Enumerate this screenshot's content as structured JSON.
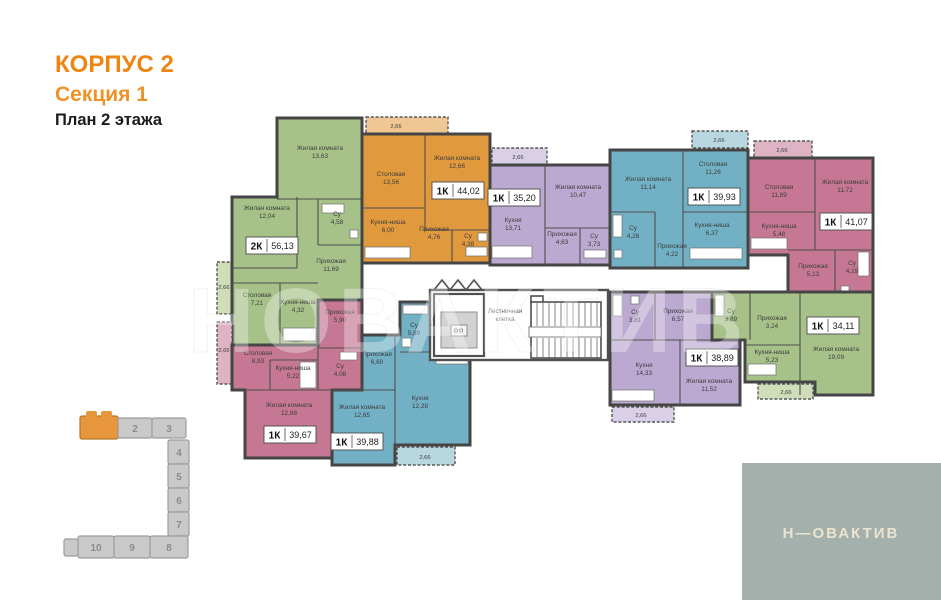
{
  "header": {
    "building": "КОРПУС 2",
    "section": "Секция 1",
    "floor": "План 2 этажа"
  },
  "watermark": "НОВАКТИВ",
  "staircase": {
    "line1": "Лестничная",
    "line2": "клетка"
  },
  "apartments": [
    {
      "id": "apt-2k-5613",
      "type": "2К",
      "total_area": "56,13",
      "color": "#a6c289",
      "balcony_area": "2,66",
      "rooms": [
        {
          "name": "Жилая комната",
          "area": "13,63"
        },
        {
          "name": "Жилая комната",
          "area": "12,04"
        },
        {
          "name": "Су",
          "area": "4,58"
        },
        {
          "name": "Прихожая",
          "area": "11,69"
        },
        {
          "name": "Столовая",
          "area": "7,21"
        },
        {
          "name": "Кухня-ниша",
          "area": "4,32"
        }
      ]
    },
    {
      "id": "apt-1k-4402",
      "type": "1К",
      "total_area": "44,02",
      "color": "#e1993d",
      "balcony_area": "2,66",
      "rooms": [
        {
          "name": "Столовая",
          "area": "13,56"
        },
        {
          "name": "Жилая комната",
          "area": "12,66"
        },
        {
          "name": "Кухня-ниша",
          "area": "6,00"
        },
        {
          "name": "Прихожая",
          "area": "4,76"
        },
        {
          "name": "Су",
          "area": "4,38"
        }
      ]
    },
    {
      "id": "apt-1k-3520",
      "type": "1К",
      "total_area": "35,20",
      "color": "#bba9d1",
      "balcony_area": "2,66",
      "rooms": [
        {
          "name": "Жилая комната",
          "area": "10,47"
        },
        {
          "name": "Кухня",
          "area": "13,71"
        },
        {
          "name": "Прихожая",
          "area": "4,63"
        },
        {
          "name": "Су",
          "area": "3,73"
        }
      ]
    },
    {
      "id": "apt-1k-3993",
      "type": "1К",
      "total_area": "39,93",
      "color": "#72b1c5",
      "balcony_area": "2,66",
      "rooms": [
        {
          "name": "Жилая комната",
          "area": "11,14"
        },
        {
          "name": "Столовая",
          "area": "11,26"
        },
        {
          "name": "Кухня-ниша",
          "area": "6,37"
        },
        {
          "name": "Су",
          "area": "4,28"
        },
        {
          "name": "Прихожая",
          "area": "4,22"
        }
      ]
    },
    {
      "id": "apt-1k-4107",
      "type": "1К",
      "total_area": "41,07",
      "color": "#c57793",
      "balcony_area": "2,66",
      "rooms": [
        {
          "name": "Столовая",
          "area": "11,89"
        },
        {
          "name": "Жилая комната",
          "area": "11,72"
        },
        {
          "name": "Кухня-ниша",
          "area": "5,48"
        },
        {
          "name": "Прихожая",
          "area": "5,13"
        },
        {
          "name": "Су",
          "area": "4,19"
        }
      ]
    },
    {
      "id": "apt-1k-3967",
      "type": "1К",
      "total_area": "39,67",
      "color": "#c57793",
      "balcony_area": "2,66",
      "rooms": [
        {
          "name": "Прихожая",
          "area": "5,90"
        },
        {
          "name": "Столовая",
          "area": "8,93"
        },
        {
          "name": "Кухня-ниша",
          "area": "5,22"
        },
        {
          "name": "Су",
          "area": "4,08"
        },
        {
          "name": "Жилая комната",
          "area": "12,88"
        }
      ]
    },
    {
      "id": "apt-1k-3988",
      "type": "1К",
      "total_area": "39,88",
      "color": "#72b1c5",
      "balcony_area": "2,66",
      "rooms": [
        {
          "name": "Су",
          "area": "5,89"
        },
        {
          "name": "Прихожая",
          "area": "6,60"
        },
        {
          "name": "Кухня",
          "area": "12,28"
        },
        {
          "name": "Жилая комната",
          "area": "12,65"
        }
      ]
    },
    {
      "id": "apt-1k-3889",
      "type": "1К",
      "total_area": "38,89",
      "color": "#bba9d1",
      "balcony_area": "2,66",
      "rooms": [
        {
          "name": "Су",
          "area": "3,81"
        },
        {
          "name": "Прихожая",
          "area": "6,57"
        },
        {
          "name": "Кухня",
          "area": "14,33"
        },
        {
          "name": "Жилая комната",
          "area": "11,52"
        }
      ]
    },
    {
      "id": "apt-1k-3411",
      "type": "1К",
      "total_area": "34,11",
      "color": "#a6c289",
      "balcony_area": "2,66",
      "rooms": [
        {
          "name": "Су",
          "area": "3,89"
        },
        {
          "name": "Прихожая",
          "area": "3,24"
        },
        {
          "name": "Кухня-ниша",
          "area": "5,23"
        },
        {
          "name": "Жилая комната",
          "area": "19,09"
        }
      ]
    }
  ],
  "locator": {
    "sections": [
      {
        "label": "2"
      },
      {
        "label": "3"
      },
      {
        "label": "4"
      },
      {
        "label": "5"
      },
      {
        "label": "6"
      },
      {
        "label": "7"
      },
      {
        "label": "8"
      },
      {
        "label": "9"
      },
      {
        "label": "10"
      }
    ]
  },
  "logo": {
    "text": "Н—ОВАКТИВ"
  },
  "colors": {
    "accent": "#ee8511",
    "locator_active": "#e8963c",
    "logo_bg": "#a3b0ac"
  }
}
